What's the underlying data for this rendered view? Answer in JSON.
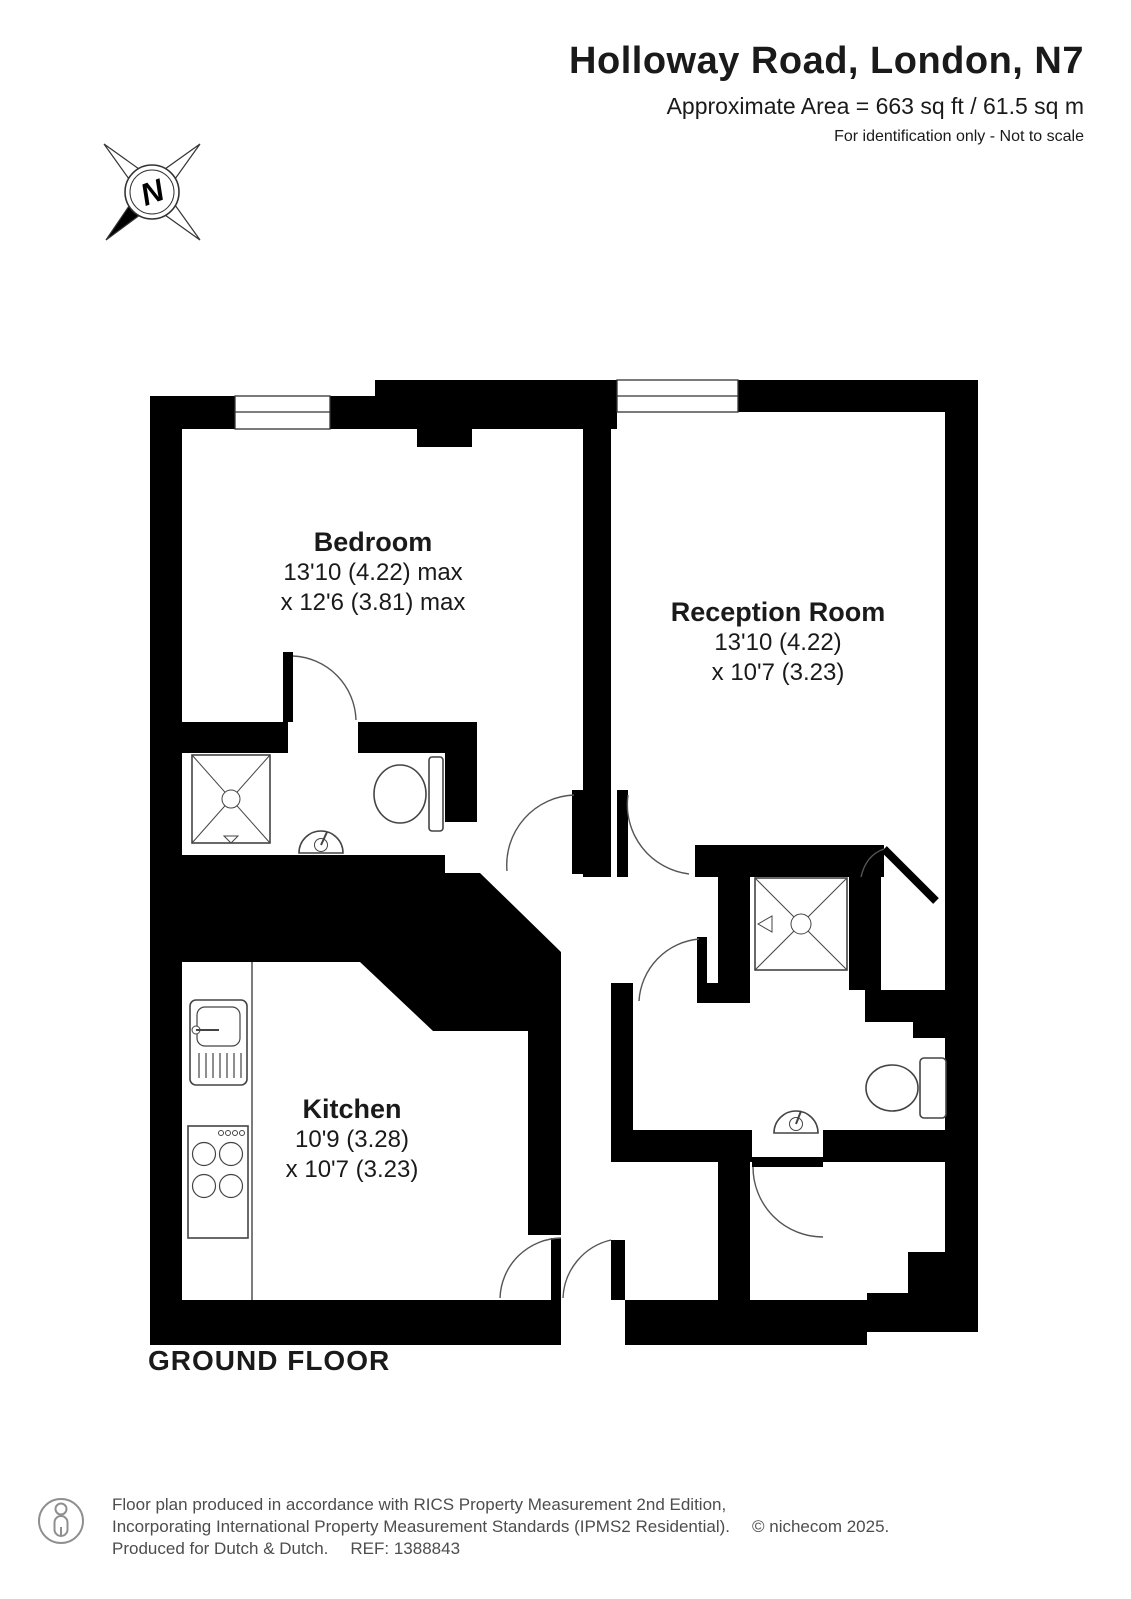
{
  "header": {
    "title": "Holloway Road, London, N7",
    "area_line": "Approximate Area = 663 sq ft / 61.5 sq m",
    "note": "For identification only - Not to scale"
  },
  "compass": {
    "north_label": "N"
  },
  "rooms": [
    {
      "name": "Bedroom",
      "dim1": "13'10 (4.22) max",
      "dim2": "x 12'6 (3.81) max"
    },
    {
      "name": "Reception Room",
      "dim1": "13'10 (4.22)",
      "dim2": "x 10'7 (3.23)"
    },
    {
      "name": "Kitchen",
      "dim1": "10'9 (3.28)",
      "dim2": "x 10'7 (3.23)"
    }
  ],
  "floor_label": "GROUND FLOOR",
  "footer": {
    "line1": "Floor plan produced in accordance with RICS Property Measurement 2nd Edition,",
    "line2": "Incorporating International Property Measurement Standards (IPMS2 Residential).",
    "copyright": "© nichecom 2025.",
    "line3": "Produced for Dutch & Dutch.",
    "ref": "REF: 1388843"
  }
}
